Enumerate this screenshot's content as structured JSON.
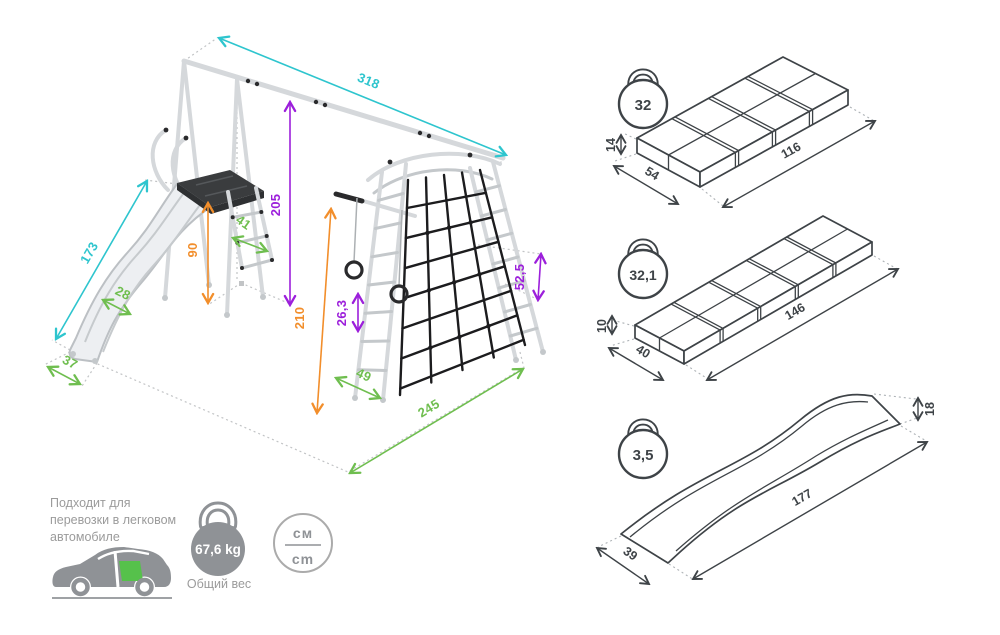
{
  "colors": {
    "cyan": "#2EC5CE",
    "purple": "#9C1FDB",
    "orange": "#F28E2B",
    "green": "#6FBE4F",
    "dark": "#3E4347",
    "gray": "#9B9B9B",
    "icon": "#8F9296",
    "tube": "#D5D8DB",
    "tube2": "#C4C8CB",
    "platform": "#3A3C3E",
    "net": "#1C1C1E",
    "pack_green": "#56C14B"
  },
  "structure_dims": {
    "beam_length": "318",
    "slide_length": "173",
    "total_height": "205",
    "platform_height": "90",
    "tower_height": "210",
    "ladder_width": "41",
    "slide_width": "28",
    "slide_exit_width": "37",
    "tower_rung_width": "49",
    "base_length": "245",
    "ring_step": "26,3",
    "net_step": "52,5"
  },
  "packages": [
    {
      "weight": "32",
      "height": "14",
      "depth": "54",
      "length": "116"
    },
    {
      "weight": "32,1",
      "height": "10",
      "depth": "40",
      "length": "146"
    },
    {
      "weight": "3,5",
      "height": "18",
      "depth": "39",
      "length": "177"
    }
  ],
  "info": {
    "car_note_line1": "Подходит для",
    "car_note_line2": "перевозки в легковом",
    "car_note_line3": "автомобиле",
    "total_weight": "67,6 kg",
    "total_weight_label": "Общий вес",
    "units_top": "см",
    "units_bottom": "cm"
  }
}
